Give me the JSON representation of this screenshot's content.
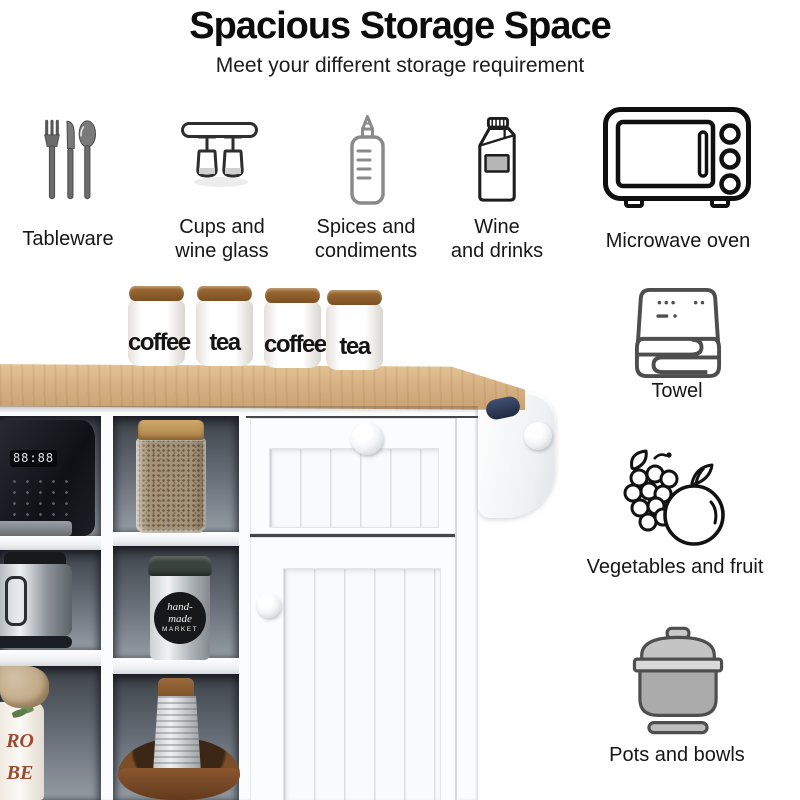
{
  "header": {
    "title": "Spacious Storage Space",
    "subtitle": "Meet your different storage requirement"
  },
  "features": [
    {
      "label_line1": "Tableware",
      "label_line2": ""
    },
    {
      "label_line1": "Cups and",
      "label_line2": "wine glass"
    },
    {
      "label_line1": "Spices and",
      "label_line2": "condiments"
    },
    {
      "label_line1": "Wine",
      "label_line2": "and drinks"
    },
    {
      "label_line1": "Microwave oven",
      "label_line2": ""
    }
  ],
  "side_features": [
    {
      "label": "Towel"
    },
    {
      "label": "Vegetables and fruit"
    },
    {
      "label": "Pots and bowls"
    }
  ],
  "icons": {
    "tableware": "cutlery-icon",
    "cups": "wine-glass-rack-icon",
    "spices": "squeeze-bottle-icon",
    "wine": "milk-carton-icon",
    "microwave": "microwave-oven-icon",
    "towel": "folded-towel-icon",
    "vegetables": "grapes-and-apple-icon",
    "pots": "cooking-pot-icon"
  },
  "photo": {
    "canisters": [
      "coffee",
      "tea",
      "coffee",
      "tea"
    ],
    "coffee_machine_display": "88:88",
    "handmade_canister_line1": "hand-",
    "handmade_canister_line2": "made",
    "handmade_canister_line3": "MARKET",
    "jar_letters_line1": "RO",
    "jar_letters_line2": "BE"
  },
  "colors": {
    "countertop_wood": "#d9b486",
    "cabinet_white": "#fbfcfd",
    "cubby_interior": "#6a717a",
    "icon_gray": "#8a8a8a",
    "icon_dark": "#141414",
    "towel_roll_navy": "#2c3854",
    "canister_lid_brown": "#8a5a28"
  }
}
